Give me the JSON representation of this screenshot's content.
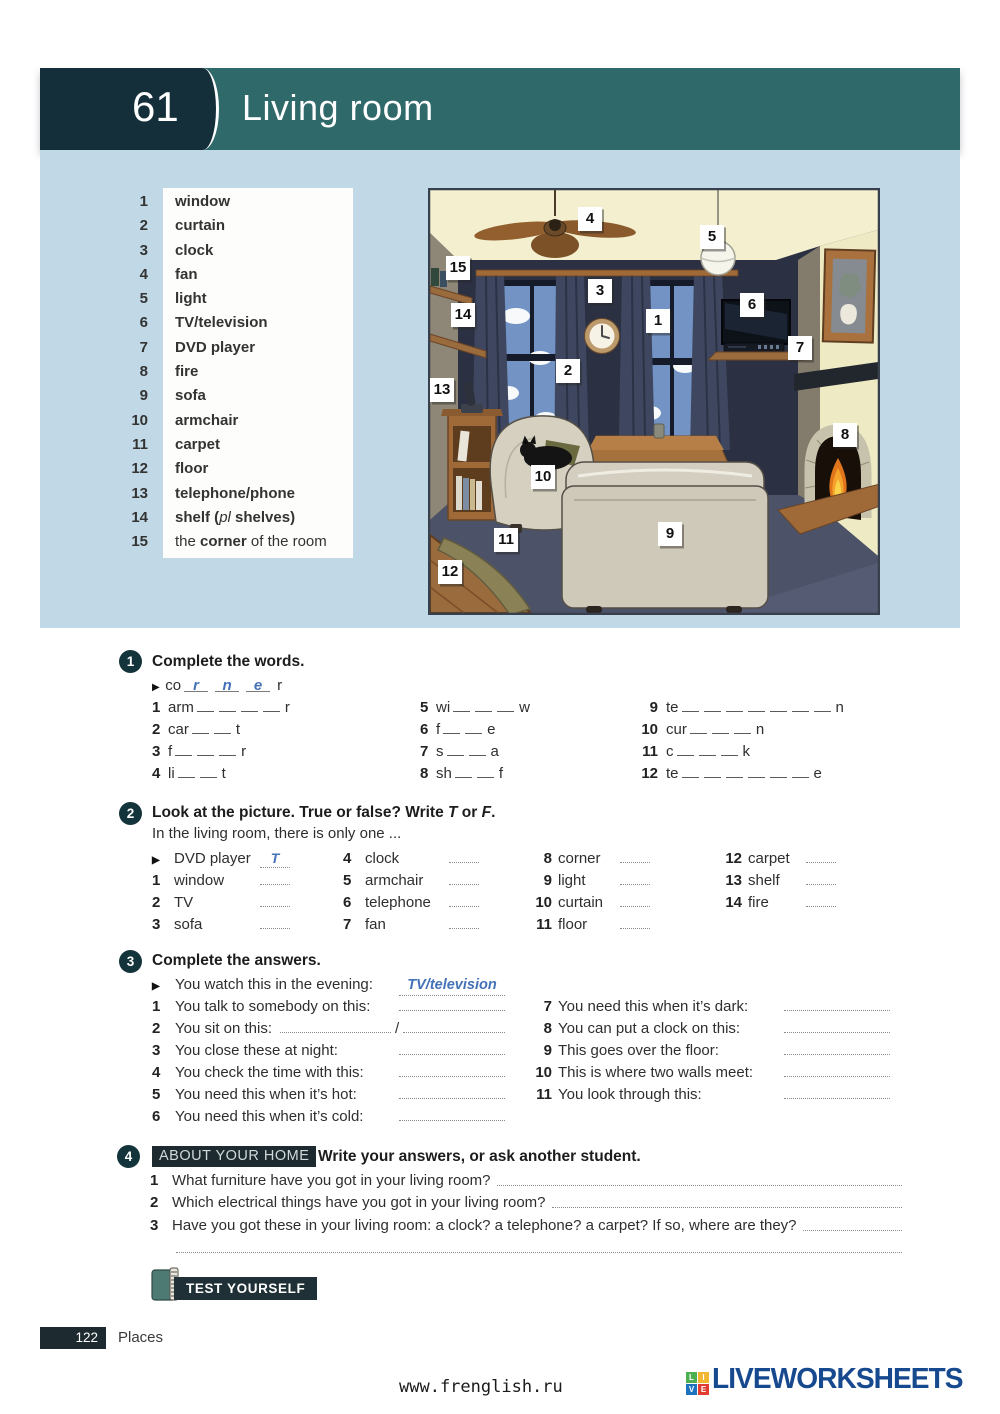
{
  "header": {
    "unit_number": "61",
    "title": "Living room"
  },
  "colors": {
    "header_teal": "#30696a",
    "unit_box": "#142f3a",
    "panel_blue": "#c1d9e6",
    "hand_blue": "#4472b8",
    "dark_badge": "#1d2b31"
  },
  "word_list": [
    {
      "num": "1",
      "parts": [
        {
          "t": "window",
          "s": "b"
        }
      ]
    },
    {
      "num": "2",
      "parts": [
        {
          "t": "curtain",
          "s": "b"
        }
      ]
    },
    {
      "num": "3",
      "parts": [
        {
          "t": "clock",
          "s": "b"
        }
      ]
    },
    {
      "num": "4",
      "parts": [
        {
          "t": "fan",
          "s": "b"
        }
      ]
    },
    {
      "num": "5",
      "parts": [
        {
          "t": "light",
          "s": "b"
        }
      ]
    },
    {
      "num": "6",
      "parts": [
        {
          "t": "TV/television",
          "s": "b"
        }
      ]
    },
    {
      "num": "7",
      "parts": [
        {
          "t": "DVD player",
          "s": "b"
        }
      ]
    },
    {
      "num": "8",
      "parts": [
        {
          "t": "fire",
          "s": "b"
        }
      ]
    },
    {
      "num": "9",
      "parts": [
        {
          "t": "sofa",
          "s": "b"
        }
      ]
    },
    {
      "num": "10",
      "parts": [
        {
          "t": "armchair",
          "s": "b"
        }
      ]
    },
    {
      "num": "11",
      "parts": [
        {
          "t": "carpet",
          "s": "b"
        }
      ]
    },
    {
      "num": "12",
      "parts": [
        {
          "t": "floor",
          "s": "b"
        }
      ]
    },
    {
      "num": "13",
      "parts": [
        {
          "t": "telephone/phone",
          "s": "b"
        }
      ]
    },
    {
      "num": "14",
      "parts": [
        {
          "t": "shelf (",
          "s": "b"
        },
        {
          "t": "pl",
          "s": "i"
        },
        {
          "t": " shelves)",
          "s": "b"
        }
      ]
    },
    {
      "num": "15",
      "parts": [
        {
          "t": "the ",
          "s": "n"
        },
        {
          "t": "corner",
          "s": "b"
        },
        {
          "t": " of the room",
          "s": "n"
        }
      ]
    }
  ],
  "illustration": {
    "labels": [
      {
        "n": "4",
        "x": 150,
        "y": 19
      },
      {
        "n": "5",
        "x": 272,
        "y": 37
      },
      {
        "n": "15",
        "x": 18,
        "y": 68
      },
      {
        "n": "3",
        "x": 160,
        "y": 91
      },
      {
        "n": "6",
        "x": 312,
        "y": 105
      },
      {
        "n": "14",
        "x": 23,
        "y": 115
      },
      {
        "n": "1",
        "x": 218,
        "y": 121
      },
      {
        "n": "7",
        "x": 360,
        "y": 148
      },
      {
        "n": "2",
        "x": 128,
        "y": 171
      },
      {
        "n": "13",
        "x": 2,
        "y": 190
      },
      {
        "n": "8",
        "x": 405,
        "y": 235
      },
      {
        "n": "10",
        "x": 103,
        "y": 277
      },
      {
        "n": "9",
        "x": 230,
        "y": 334
      },
      {
        "n": "11",
        "x": 66,
        "y": 340
      },
      {
        "n": "12",
        "x": 10,
        "y": 372
      }
    ]
  },
  "ex1": {
    "number": "1",
    "title": "Complete the words.",
    "example": {
      "marker": "▶",
      "prefix": "co",
      "letters": [
        "r",
        "n",
        "e"
      ],
      "suffix": "r"
    },
    "col1": [
      {
        "num": "1",
        "pre": "arm",
        "blanks": 4,
        "suf": "r"
      },
      {
        "num": "2",
        "pre": "car",
        "blanks": 2,
        "suf": "t"
      },
      {
        "num": "3",
        "pre": "f",
        "blanks": 3,
        "suf": "r"
      },
      {
        "num": "4",
        "pre": "li",
        "blanks": 2,
        "suf": "t"
      }
    ],
    "col2": [
      {
        "num": "5",
        "pre": "wi",
        "blanks": 3,
        "suf": "w"
      },
      {
        "num": "6",
        "pre": "f",
        "blanks": 2,
        "suf": "e"
      },
      {
        "num": "7",
        "pre": "s",
        "blanks": 2,
        "suf": "a"
      },
      {
        "num": "8",
        "pre": "sh",
        "blanks": 2,
        "suf": "f"
      }
    ],
    "col3": [
      {
        "num": "9",
        "pre": "te",
        "blanks": 7,
        "suf": "n"
      },
      {
        "num": "10",
        "pre": "cur",
        "blanks": 3,
        "suf": "n"
      },
      {
        "num": "11",
        "pre": "c",
        "blanks": 3,
        "suf": "k"
      },
      {
        "num": "12",
        "pre": "te",
        "blanks": 6,
        "suf": "e"
      }
    ]
  },
  "ex2": {
    "number": "2",
    "title_parts": [
      {
        "t": "Look at the picture. True or false? Write "
      },
      {
        "t": "T",
        "i": true
      },
      {
        "t": " or "
      },
      {
        "t": "F",
        "i": true
      },
      {
        "t": "."
      }
    ],
    "subtitle": "In the living room, there is only one ...",
    "col1": [
      {
        "marker": "▶",
        "label": "DVD player",
        "answer": "T"
      },
      {
        "num": "1",
        "label": "window"
      },
      {
        "num": "2",
        "label": "TV"
      },
      {
        "num": "3",
        "label": "sofa"
      }
    ],
    "col2": [
      {
        "num": "4",
        "label": "clock"
      },
      {
        "num": "5",
        "label": "armchair"
      },
      {
        "num": "6",
        "label": "telephone"
      },
      {
        "num": "7",
        "label": "fan"
      }
    ],
    "col3": [
      {
        "num": "8",
        "label": "corner"
      },
      {
        "num": "9",
        "label": "light"
      },
      {
        "num": "10",
        "label": "curtain"
      },
      {
        "num": "11",
        "label": "floor"
      }
    ],
    "col4": [
      {
        "num": "12",
        "label": "carpet"
      },
      {
        "num": "13",
        "label": "shelf"
      },
      {
        "num": "14",
        "label": "fire"
      }
    ]
  },
  "ex3": {
    "number": "3",
    "title": "Complete the answers.",
    "col1": [
      {
        "marker": "▶",
        "prompt": "You watch this in the evening:",
        "answer": "TV/television"
      },
      {
        "num": "1",
        "prompt": "You talk to somebody on this:"
      },
      {
        "num": "2",
        "prompt": "You sit on this:",
        "inline_two": true,
        "separator": "/"
      },
      {
        "num": "3",
        "prompt": "You close these at night:"
      },
      {
        "num": "4",
        "prompt": "You check the time with this:"
      },
      {
        "num": "5",
        "prompt": "You need this when it’s hot:"
      },
      {
        "num": "6",
        "prompt": "You need this when it’s cold:"
      }
    ],
    "col2": [
      {
        "num": "7",
        "prompt": "You need this when it’s dark:"
      },
      {
        "num": "8",
        "prompt": "You can put a clock on this:"
      },
      {
        "num": "9",
        "prompt": "This goes over the floor:"
      },
      {
        "num": "10",
        "prompt": "This is where two walls meet:"
      },
      {
        "num": "11",
        "prompt": "You look through this:"
      }
    ]
  },
  "ex4": {
    "number": "4",
    "badge": "ABOUT YOUR HOME",
    "title": "Write your answers, or ask another student.",
    "items": [
      {
        "num": "1",
        "text": "What furniture have you got in your living room?"
      },
      {
        "num": "2",
        "text": "Which electrical things have you got in your living room?"
      },
      {
        "num": "3",
        "text": "Have you got these in your living room: a clock? a telephone? a carpet? If so, where are they?"
      }
    ]
  },
  "test_yourself": "TEST YOURSELF",
  "footer": {
    "page": "122",
    "section": "Places"
  },
  "watermark": "www.frenglish.ru",
  "logo": {
    "squares": [
      {
        "t": "L",
        "c": "#4caf50"
      },
      {
        "t": "I",
        "c": "#f2b630"
      },
      {
        "t": "V",
        "c": "#1e73be"
      },
      {
        "t": "E",
        "c": "#e03c31"
      }
    ],
    "text": "LIVEWORKSHEETS"
  }
}
